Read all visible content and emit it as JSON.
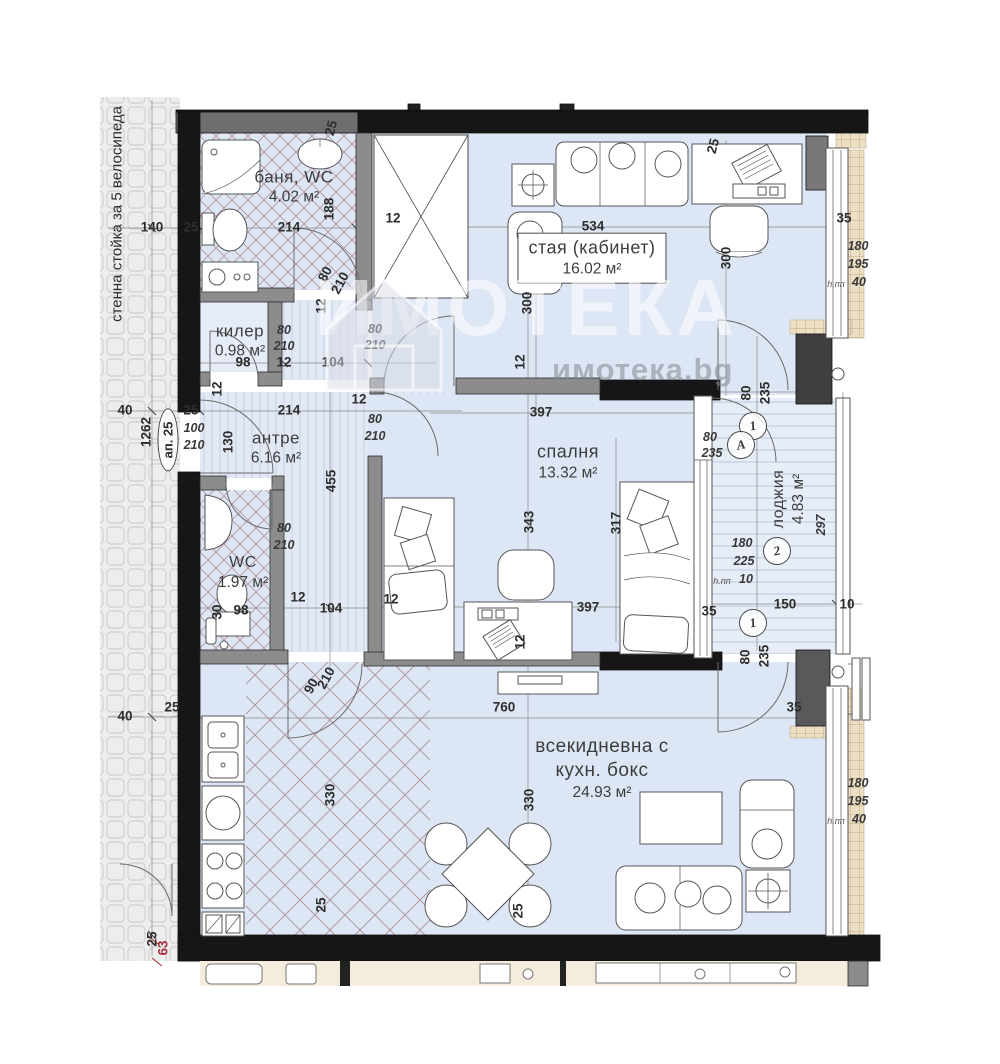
{
  "watermark": {
    "title": "ИМОТЕКА",
    "domain": "имотека.bg"
  },
  "annotations": {
    "side_label": "стенна стойка за 5 велосипеда",
    "apartment_badge": "ап. 25"
  },
  "colors": {
    "floor_blue": "#dde6f4",
    "hall_blue": "#e2e9f5",
    "wall_black": "#161616",
    "wall_gray": "#8c8c8c",
    "hatch_pink": "#b5929a",
    "tile_bg": "#ededed",
    "sill_beige": "#ecdfc6",
    "red_label": "#a8303c",
    "watermark_gray": "#80868e"
  },
  "rooms": [
    {
      "id": "bath",
      "lines": [
        "баня, WC"
      ],
      "area": "4.02 м²",
      "x": 294,
      "y": 187,
      "fs": 17
    },
    {
      "id": "closet",
      "lines": [
        "килер"
      ],
      "area": "0.98 м²",
      "x": 240,
      "y": 341,
      "fs": 17
    },
    {
      "id": "office",
      "lines": [
        "стая (кабинет)"
      ],
      "area": "16.02 м²",
      "x": 592,
      "y": 258,
      "fs": 18,
      "boxed": true
    },
    {
      "id": "hall",
      "lines": [
        "антре"
      ],
      "area": "6.16 м²",
      "x": 276,
      "y": 448,
      "fs": 17
    },
    {
      "id": "bedroom",
      "lines": [
        "спалня"
      ],
      "area": "13.32 м²",
      "x": 568,
      "y": 462,
      "fs": 18
    },
    {
      "id": "wc",
      "lines": [
        "WC"
      ],
      "area": "1.97 м²",
      "x": 243,
      "y": 573,
      "fs": 16
    },
    {
      "id": "loggia",
      "lines": [
        "лоджия"
      ],
      "area": "4.83 м²",
      "x": 789,
      "y": 499,
      "fs": 16,
      "rot": -90
    },
    {
      "id": "living",
      "lines": [
        "всекидневна с",
        "кухн. бокс"
      ],
      "area": "24.93 м²",
      "x": 602,
      "y": 769,
      "fs": 19
    }
  ],
  "markers": [
    {
      "t": "1",
      "x": 753,
      "y": 426
    },
    {
      "t": "A",
      "x": 741,
      "y": 445
    },
    {
      "t": "2",
      "x": 777,
      "y": 551
    },
    {
      "t": "1",
      "x": 753,
      "y": 623
    }
  ],
  "dimensions": [
    {
      "t": "140",
      "x": 152,
      "y": 227
    },
    {
      "t": "25",
      "x": 191,
      "y": 227
    },
    {
      "t": "214",
      "x": 289,
      "y": 227
    },
    {
      "t": "188",
      "x": 329,
      "y": 209,
      "r": -90
    },
    {
      "t": "12",
      "x": 393,
      "y": 218
    },
    {
      "t": "25",
      "x": 331,
      "y": 128,
      "r": -75
    },
    {
      "t": "25",
      "x": 713,
      "y": 146,
      "r": -75
    },
    {
      "t": "534",
      "x": 593,
      "y": 226
    },
    {
      "t": "300",
      "x": 527,
      "y": 303,
      "r": -90
    },
    {
      "t": "300",
      "x": 726,
      "y": 258,
      "r": -90
    },
    {
      "t": "12",
      "x": 520,
      "y": 362,
      "r": -90
    },
    {
      "t": "35",
      "x": 844,
      "y": 218
    },
    {
      "t": "180",
      "x": 858,
      "y": 246,
      "c": "i"
    },
    {
      "t": "195",
      "x": 858,
      "y": 264,
      "c": "i"
    },
    {
      "t": "40",
      "x": 859,
      "y": 282,
      "c": "i"
    },
    {
      "t": "h.пп",
      "x": 836,
      "y": 284,
      "c": "sm"
    },
    {
      "t": "80",
      "x": 325,
      "y": 274,
      "r": -62
    },
    {
      "t": "210",
      "x": 340,
      "y": 283,
      "r": -62
    },
    {
      "t": "12",
      "x": 321,
      "y": 306,
      "r": -90
    },
    {
      "t": "80",
      "x": 284,
      "y": 330,
      "c": "i"
    },
    {
      "t": "210",
      "x": 284,
      "y": 346,
      "c": "i"
    },
    {
      "t": "80",
      "x": 375,
      "y": 329,
      "c": "i"
    },
    {
      "t": "210",
      "x": 375,
      "y": 345,
      "c": "i"
    },
    {
      "t": "98",
      "x": 243,
      "y": 362
    },
    {
      "t": "12",
      "x": 284,
      "y": 362
    },
    {
      "t": "104",
      "x": 333,
      "y": 362
    },
    {
      "t": "40",
      "x": 125,
      "y": 410
    },
    {
      "t": "25",
      "x": 191,
      "y": 410
    },
    {
      "t": "214",
      "x": 289,
      "y": 410
    },
    {
      "t": "1262",
      "x": 146,
      "y": 432,
      "r": -90
    },
    {
      "t": "100",
      "x": 194,
      "y": 428,
      "c": "i"
    },
    {
      "t": "210",
      "x": 194,
      "y": 445,
      "c": "i"
    },
    {
      "t": "130",
      "x": 228,
      "y": 442,
      "r": -90
    },
    {
      "t": "12",
      "x": 217,
      "y": 389,
      "r": -90
    },
    {
      "t": "12",
      "x": 359,
      "y": 399
    },
    {
      "t": "80",
      "x": 375,
      "y": 419,
      "c": "i"
    },
    {
      "t": "210",
      "x": 375,
      "y": 436,
      "c": "i"
    },
    {
      "t": "455",
      "x": 331,
      "y": 481,
      "r": -90
    },
    {
      "t": "397",
      "x": 541,
      "y": 412
    },
    {
      "t": "343",
      "x": 529,
      "y": 522,
      "r": -90
    },
    {
      "t": "317",
      "x": 616,
      "y": 523,
      "r": -90
    },
    {
      "t": "80",
      "x": 746,
      "y": 393,
      "r": -90
    },
    {
      "t": "235",
      "x": 765,
      "y": 393,
      "r": -90
    },
    {
      "t": "80",
      "x": 710,
      "y": 437,
      "c": "i"
    },
    {
      "t": "235",
      "x": 712,
      "y": 453,
      "c": "i"
    },
    {
      "t": "297",
      "x": 821,
      "y": 525,
      "r": -90,
      "c": "i"
    },
    {
      "t": "180",
      "x": 742,
      "y": 543,
      "c": "i"
    },
    {
      "t": "225",
      "x": 744,
      "y": 561,
      "c": "i"
    },
    {
      "t": "10",
      "x": 746,
      "y": 579,
      "c": "i"
    },
    {
      "t": "h.пп",
      "x": 722,
      "y": 581,
      "c": "sm"
    },
    {
      "t": "80",
      "x": 284,
      "y": 528,
      "c": "i"
    },
    {
      "t": "210",
      "x": 284,
      "y": 545,
      "c": "i"
    },
    {
      "t": "30",
      "x": 217,
      "y": 612,
      "r": -90
    },
    {
      "t": "98",
      "x": 241,
      "y": 610
    },
    {
      "t": "12",
      "x": 298,
      "y": 597
    },
    {
      "t": "104",
      "x": 331,
      "y": 608
    },
    {
      "t": "397",
      "x": 588,
      "y": 607
    },
    {
      "t": "12",
      "x": 391,
      "y": 599
    },
    {
      "t": "12",
      "x": 520,
      "y": 642,
      "r": -90
    },
    {
      "t": "150",
      "x": 785,
      "y": 604
    },
    {
      "t": "10",
      "x": 847,
      "y": 604
    },
    {
      "t": "35",
      "x": 709,
      "y": 611
    },
    {
      "t": "80",
      "x": 745,
      "y": 657,
      "r": -90
    },
    {
      "t": "235",
      "x": 764,
      "y": 656,
      "r": -90
    },
    {
      "t": "35",
      "x": 794,
      "y": 707
    },
    {
      "t": "90",
      "x": 311,
      "y": 686,
      "r": -62
    },
    {
      "t": "210",
      "x": 326,
      "y": 678,
      "r": -62
    },
    {
      "t": "760",
      "x": 504,
      "y": 707
    },
    {
      "t": "40",
      "x": 125,
      "y": 716
    },
    {
      "t": "25",
      "x": 172,
      "y": 707
    },
    {
      "t": "330",
      "x": 330,
      "y": 795,
      "r": -90
    },
    {
      "t": "330",
      "x": 529,
      "y": 800,
      "r": -90
    },
    {
      "t": "180",
      "x": 858,
      "y": 783,
      "c": "i"
    },
    {
      "t": "195",
      "x": 858,
      "y": 801,
      "c": "i"
    },
    {
      "t": "40",
      "x": 859,
      "y": 819,
      "c": "i"
    },
    {
      "t": "h.пп",
      "x": 836,
      "y": 821,
      "c": "sm"
    },
    {
      "t": "25",
      "x": 321,
      "y": 905,
      "r": -90
    },
    {
      "t": "25",
      "x": 518,
      "y": 911,
      "r": -90
    },
    {
      "t": "25",
      "x": 152,
      "y": 939,
      "r": -90
    },
    {
      "t": "63",
      "x": 163,
      "y": 948,
      "r": -90,
      "c": "red"
    }
  ]
}
